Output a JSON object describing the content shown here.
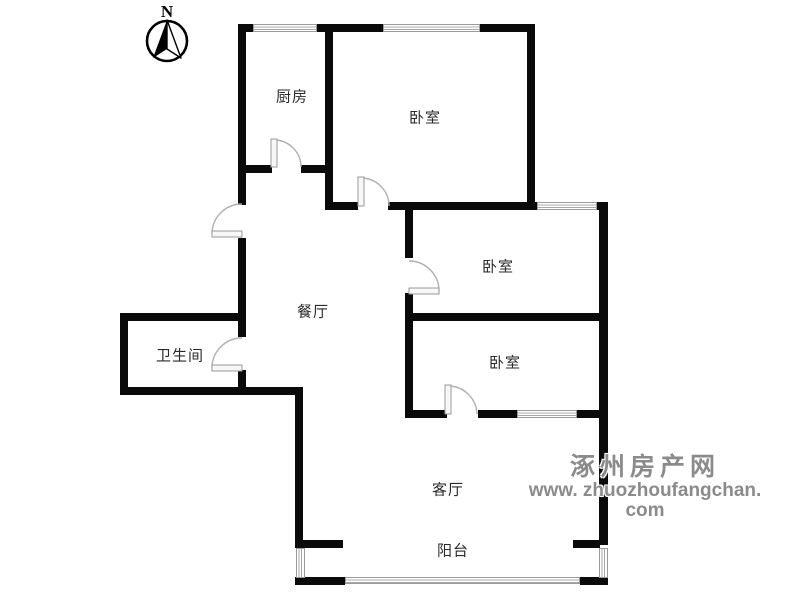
{
  "compass": {
    "label": "N"
  },
  "watermark": {
    "line1": "涿州房产网",
    "line2": "www. zhuozhoufangchan. com"
  },
  "rooms": [
    {
      "id": "kitchen",
      "label": "厨房",
      "cx": 292,
      "cy": 96
    },
    {
      "id": "bedroom-north",
      "label": "卧室",
      "cx": 425,
      "cy": 117
    },
    {
      "id": "bedroom-middle",
      "label": "卧室",
      "cx": 498,
      "cy": 266
    },
    {
      "id": "bedroom-south",
      "label": "卧室",
      "cx": 505,
      "cy": 362
    },
    {
      "id": "dining",
      "label": "餐厅",
      "cx": 313,
      "cy": 311
    },
    {
      "id": "bathroom",
      "label": "卫生间",
      "cx": 180,
      "cy": 355
    },
    {
      "id": "living",
      "label": "客厅",
      "cx": 448,
      "cy": 489
    },
    {
      "id": "balcony",
      "label": "阳台",
      "cx": 453,
      "cy": 550
    }
  ],
  "colors": {
    "wall": "#0a0a0a",
    "window_line": "#9a9a9a",
    "door_line": "#b0b0b0",
    "label": "#2a2a2a",
    "watermark": "#8b8b8b"
  },
  "floorplan": {
    "walls": [
      [
        238,
        24,
        297,
        8
      ],
      [
        238,
        24,
        8,
        181
      ],
      [
        238,
        238,
        8,
        99
      ],
      [
        238,
        370,
        8,
        25
      ],
      [
        238,
        165,
        34,
        8
      ],
      [
        301,
        165,
        32,
        8
      ],
      [
        325,
        24,
        8,
        186
      ],
      [
        527,
        24,
        8,
        186
      ],
      [
        325,
        202,
        33,
        8
      ],
      [
        388,
        202,
        149,
        8
      ],
      [
        597,
        202,
        11,
        8
      ],
      [
        599,
        202,
        9,
        343
      ],
      [
        405,
        313,
        203,
        8
      ],
      [
        405,
        410,
        42,
        8
      ],
      [
        478,
        410,
        39,
        8
      ],
      [
        577,
        410,
        31,
        8
      ],
      [
        120,
        313,
        126,
        8
      ],
      [
        120,
        387,
        183,
        8
      ],
      [
        120,
        313,
        8,
        82
      ],
      [
        295,
        392,
        8,
        156
      ],
      [
        405,
        210,
        8,
        48
      ],
      [
        405,
        293,
        8,
        125
      ],
      [
        303,
        540,
        40,
        8
      ],
      [
        573,
        540,
        27,
        8
      ],
      [
        295,
        577,
        50,
        8
      ],
      [
        580,
        577,
        28,
        8
      ]
    ],
    "windows": [
      {
        "x": 253,
        "y": 24,
        "w": 64,
        "h": 8,
        "dir": "h",
        "name": "kitchen-window"
      },
      {
        "x": 383,
        "y": 24,
        "w": 97,
        "h": 8,
        "dir": "h",
        "name": "bedroom-north-window"
      },
      {
        "x": 537,
        "y": 202,
        "w": 60,
        "h": 8,
        "dir": "h",
        "name": "bedroom-middle-window"
      },
      {
        "x": 517,
        "y": 410,
        "w": 60,
        "h": 8,
        "dir": "h",
        "name": "bedroom-south-window"
      },
      {
        "x": 296,
        "y": 548,
        "w": 9,
        "h": 30,
        "dir": "v",
        "name": "balcony-left-window"
      },
      {
        "x": 599,
        "y": 548,
        "w": 9,
        "h": 30,
        "dir": "v",
        "name": "balcony-right-window"
      },
      {
        "x": 345,
        "y": 577,
        "w": 235,
        "h": 7,
        "dir": "h",
        "name": "balcony-railing"
      }
    ],
    "doors": [
      {
        "name": "kitchen-door",
        "leaf": [
          271,
          139,
          6,
          28
        ],
        "arc": "M 274 140 A 27 27 0 0 1 301 167"
      },
      {
        "name": "entry-door",
        "leaf": [
          212,
          231,
          30,
          6
        ],
        "arc": "M 212 234 A 30 30 0 0 1 242 204"
      },
      {
        "name": "bathroom-door",
        "leaf": [
          212,
          365,
          30,
          6
        ],
        "arc": "M 212 368 A 30 30 0 0 1 242 338"
      },
      {
        "name": "bedroom-north-door",
        "leaf": [
          358,
          177,
          6,
          29
        ],
        "arc": "M 361 178 A 28 28 0 0 1 389 206"
      },
      {
        "name": "bedroom-middle-door",
        "leaf": [
          409,
          288,
          30,
          6
        ],
        "arc": "M 409 261 A 30 30 0 0 1 439 291"
      },
      {
        "name": "bedroom-south-door",
        "leaf": [
          445,
          385,
          6,
          29
        ],
        "arc": "M 448 386 A 29 29 0 0 1 477 414"
      }
    ]
  }
}
